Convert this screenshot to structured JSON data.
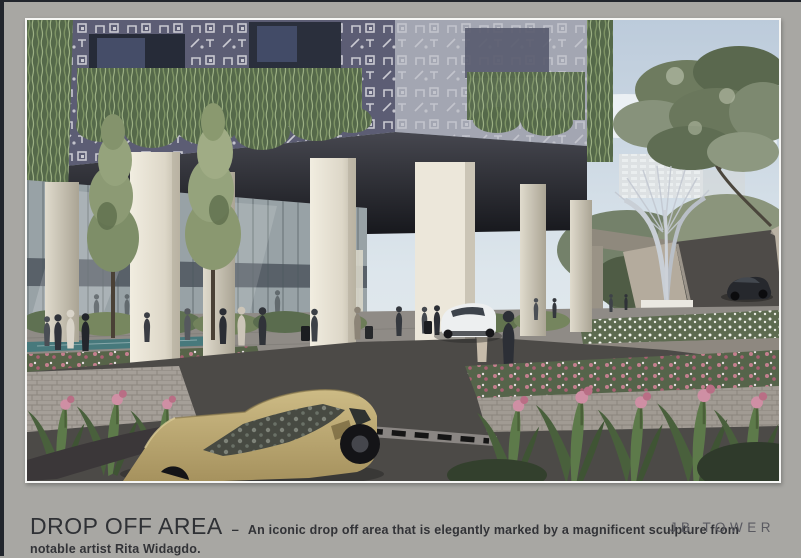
{
  "page": {
    "background": "#a8a7a3",
    "frame_border": "#f6f6f4"
  },
  "caption": {
    "title": "DROP OFF AREA",
    "separator": "–",
    "description_line1": "An iconic drop off area that is elegantly marked by a magnificent sculpture from",
    "description_line2": "notable artist Rita Widagdo."
  },
  "logo": {
    "text": "JB TOWER"
  },
  "rendering": {
    "subject": "drop-off-area-architectural-rendering",
    "palette": {
      "sky": "#c3d1df",
      "facade_front": "#5c5d74",
      "facade_side": "#a3a6b2",
      "vines": "#55694a",
      "column": "#ece7da",
      "soffit": "#22232a",
      "glass": "#98a2a6",
      "plaza": "#8f8b86",
      "road": "#4c4a47",
      "water": "#47797c",
      "gold_car": "#bda873",
      "white_car": "#edeff0",
      "sedan": "#26282d",
      "sculpture": "#ccd1d8",
      "ramp_wall": "#b4ab9d",
      "flowers_pink": "#c47f8e",
      "flowers_white": "#f2f3ee"
    }
  }
}
